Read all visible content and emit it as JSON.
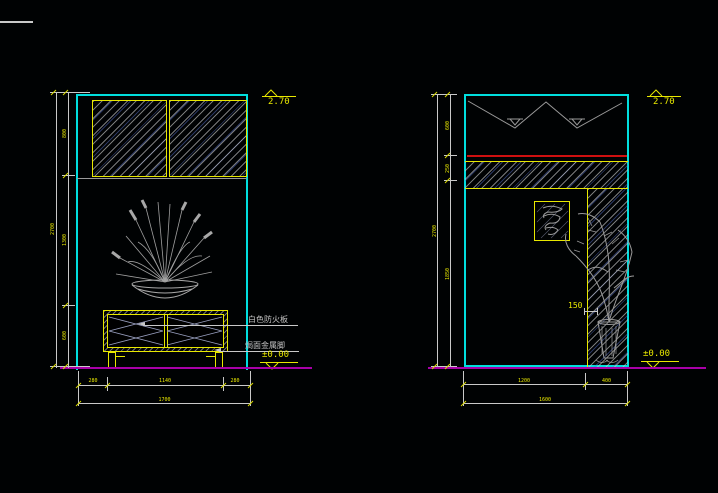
{
  "drawing": {
    "left": {
      "level_top": "2.70",
      "level_floor": "±0.00",
      "label_board": "白色防火板",
      "label_feet": "焗面金属脚",
      "dim_v": [
        "800",
        "1300",
        "600"
      ],
      "dim_v_total": "2700",
      "dim_h": [
        "280",
        "1140",
        "280"
      ],
      "dim_h_total": "1700"
    },
    "right": {
      "level_top": "2.70",
      "level_floor": "±0.00",
      "dim_band": "150",
      "dim_v": [
        "600",
        "250",
        "1850"
      ],
      "dim_v_total": "2700",
      "dim_h": [
        "1200",
        "400"
      ],
      "dim_h_total": "1600"
    },
    "colors": {
      "background": "#000203",
      "wall_line": "#00dede",
      "furniture_line": "#e8e800",
      "floor_line": "#a800a8",
      "accent_line": "#cf1010",
      "dimension_line": "#c9c9c9",
      "plant": "#a0a0a0"
    }
  }
}
